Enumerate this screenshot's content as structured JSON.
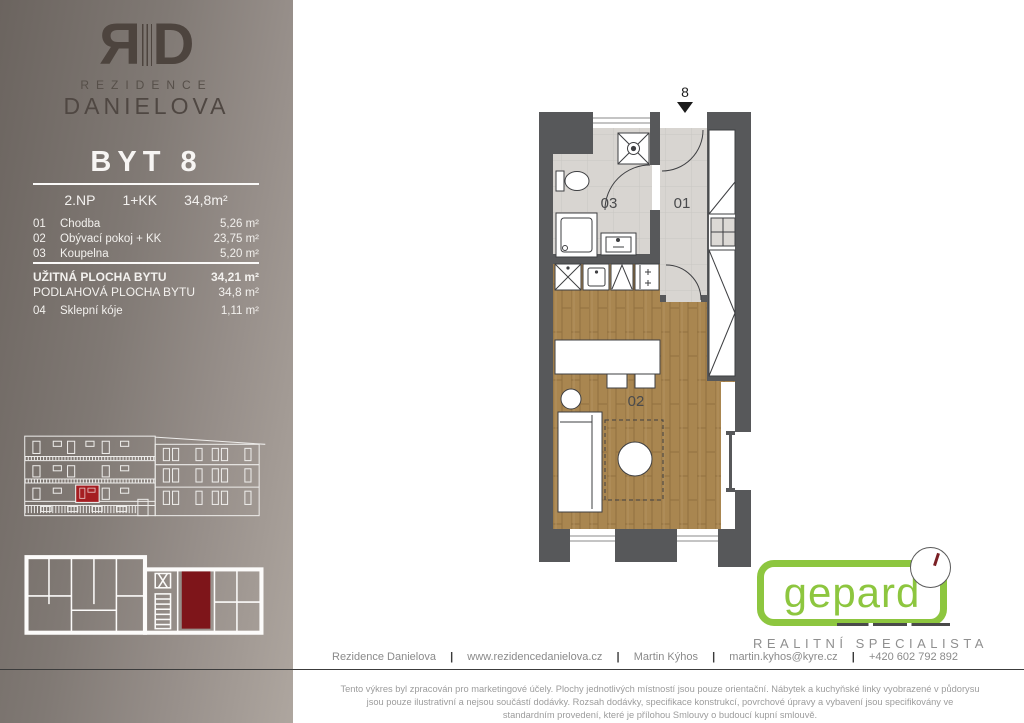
{
  "brand": {
    "monogram_r": "R",
    "monogram_d": "D",
    "line1": "REZIDENCE",
    "line2": "DANIELOVA"
  },
  "unit": {
    "title": "BYT 8",
    "floor": "2.NP",
    "disposition": "1+KK",
    "area": "34,8m²"
  },
  "rooms": [
    {
      "num": "01",
      "name": "Chodba",
      "area": "5,26 m²"
    },
    {
      "num": "02",
      "name": "Obývací pokoj + KK",
      "area": "23,75 m²"
    },
    {
      "num": "03",
      "name": "Koupelna",
      "area": "5,20 m²"
    }
  ],
  "totals": {
    "usable_label": "UŽITNÁ PLOCHA BYTU",
    "usable_value": "34,21 m²",
    "floor_label": "PODLAHOVÁ PLOCHA BYTU",
    "floor_value": "34,8 m²"
  },
  "cellar": {
    "num": "04",
    "name": "Sklepní kóje",
    "area": "1,11 m²"
  },
  "plan": {
    "entrance_label": "8",
    "labels": {
      "hall": "01",
      "living": "02",
      "bath": "03"
    }
  },
  "agency": {
    "name": "gepard",
    "tagline": "REALITNÍ SPECIALISTA"
  },
  "footer": {
    "project": "Rezidence Danielova",
    "website": "www.rezidencedanielova.cz",
    "agent": "Martin Kýhos",
    "email": "martin.kyhos@kyre.cz",
    "phone": "+420 602 792 892",
    "disclaimer": "Tento výkres byl zpracován pro marketingové účely. Plochy jednotlivých místností jsou pouze orientační. Nábytek a kuchyňské linky vyobrazené v půdorysu jsou pouze ilustrativní a nejsou součástí dodávky. Rozsah dodávky, specifikace konstrukcí, povrchové úpravy a vybavení jsou specifikovány ve standardním provedení, které je přílohou Smlouvy o budoucí kupní smlouvě."
  },
  "colors": {
    "accent_red": "#a51d21",
    "plan_red": "#7e151a",
    "brand_green": "#8dc63f",
    "wall_gray": "#57585a",
    "wood": "#a98650"
  }
}
